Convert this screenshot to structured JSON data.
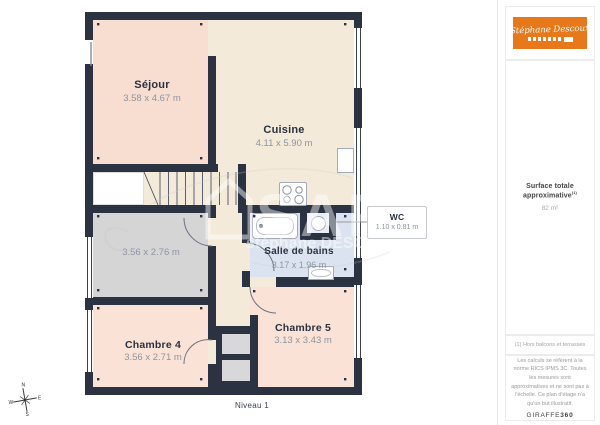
{
  "plan": {
    "level_label": "Niveau 1",
    "rooms": [
      {
        "name": "Séjour",
        "dims": "3.58 x 4.67 m"
      },
      {
        "name": "Cuisine",
        "dims": "4.11 x 5.90 m"
      },
      {
        "name": "",
        "dims": "3.56 x 2.76 m"
      },
      {
        "name": "WC",
        "dims": "1.10 x 0.81 m"
      },
      {
        "name": "Salle de bains",
        "dims": "3.17 x 1.96 m"
      },
      {
        "name": "Chambre 4",
        "dims": "3.56 x 2.71 m"
      },
      {
        "name": "Chambre 5",
        "dims": "3.13 x 3.43 m"
      }
    ],
    "compass": {
      "n": "N",
      "e": "E",
      "s": "S",
      "w": "W"
    },
    "watermark": {
      "big_text": "SAF",
      "name_text": "stéphane DESCOUX"
    }
  },
  "sidebar": {
    "logo": {
      "script_text": "Stéphane Descoux"
    },
    "surface_title": "Surface totale approximative",
    "surface_sup": "(1)",
    "surface_value": "82 m²",
    "footnote": "(1) Hors balcons et terrasses",
    "legal_text": "Les calculs se réfèrent à la norme RICS IPMS 3C. Toutes les mesures sont approximatives et ne sont pas à l'échelle. Ce plan d'étage n'a qu'un but illustratif.",
    "brand_name": "GIRAFFE",
    "brand_bold": "360"
  },
  "colors": {
    "wall": "#2b3242",
    "room_pink": "#f8ddd1",
    "room_cream": "#f3ead9",
    "room_gray": "#d5d5d6",
    "room_blue": "#dce3f0",
    "accent_orange": "#e8791b"
  }
}
